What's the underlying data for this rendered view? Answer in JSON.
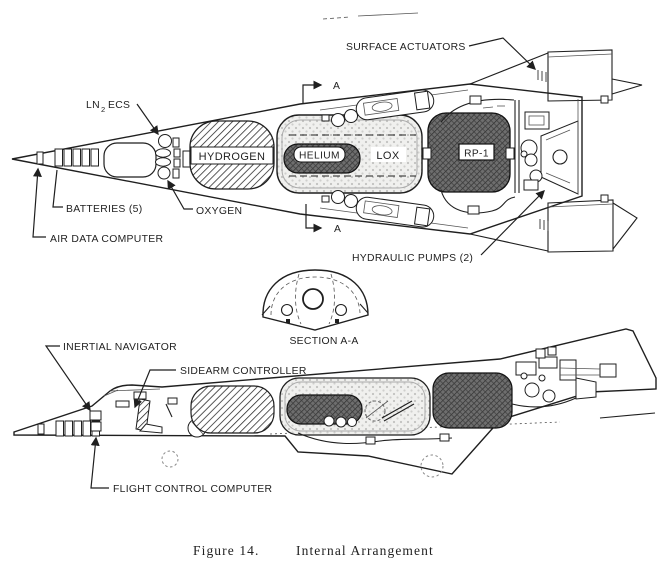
{
  "figure": {
    "caption_prefix": "Figure 14.",
    "caption_title": "Internal Arrangement"
  },
  "colors": {
    "ink": "#1f1f1f",
    "paper": "#ffffff",
    "dark_tank": "#5f5f5f",
    "light_tank": "#ececec"
  },
  "top_view": {
    "section_marker": "A",
    "labels": {
      "surface_actuators": "SURFACE ACTUATORS",
      "ln2_pre": "LN",
      "ln2_sub": "2",
      "ln2_post": "ECS",
      "batteries": "BATTERIES (5)",
      "oxygen": "OXYGEN",
      "air_data_computer": "AIR DATA COMPUTER",
      "hydraulic_pumps": "HYDRAULIC PUMPS (2)"
    },
    "tanks": {
      "hydrogen": "HYDROGEN",
      "helium": "HELIUM",
      "lox": "LOX",
      "rp1": "RP-1"
    }
  },
  "section_view": {
    "label": "SECTION A-A"
  },
  "side_view": {
    "labels": {
      "inertial_navigator": "INERTIAL NAVIGATOR",
      "sidearm_controller": "SIDEARM CONTROLLER",
      "flight_control_computer": "FLIGHT CONTROL COMPUTER"
    }
  }
}
